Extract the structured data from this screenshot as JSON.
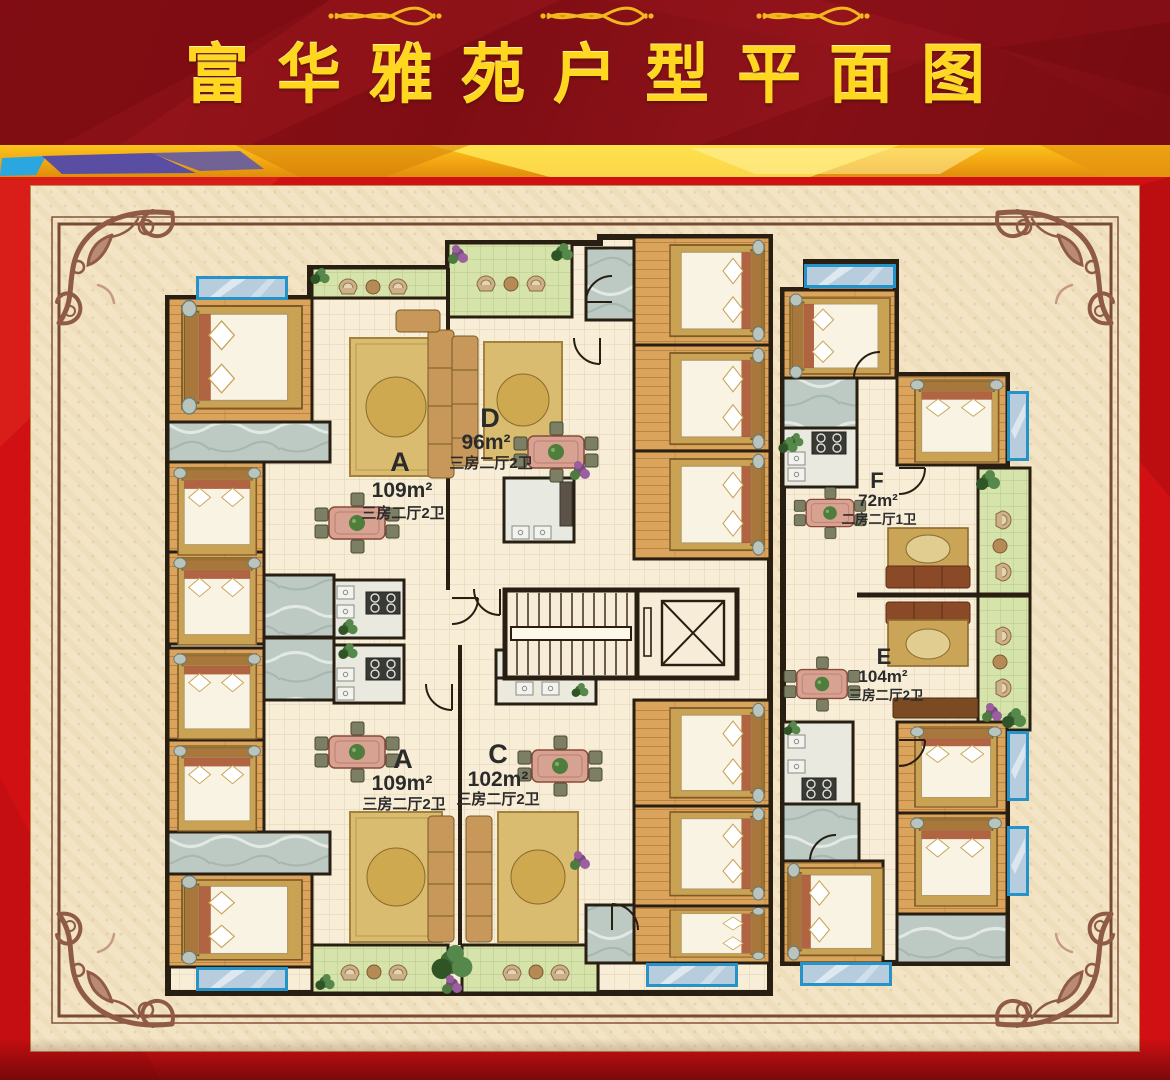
{
  "header": {
    "title": "富华雅苑户型平面图"
  },
  "plan": {
    "units": [
      {
        "letter": "A",
        "area": "109m²",
        "layout": "三房二厅2卫"
      },
      {
        "letter": "D",
        "area": "96m²",
        "layout": "三房二厅2卫"
      },
      {
        "letter": "A",
        "area": "109m²",
        "layout": "三房二厅2卫"
      },
      {
        "letter": "C",
        "area": "102m²",
        "layout": "三房二厅2卫"
      },
      {
        "letter": "F",
        "area": "72m²",
        "layout": "二房二厅1卫"
      },
      {
        "letter": "E",
        "area": "104m²",
        "layout": "三房二厅2卫"
      }
    ]
  },
  "colors": {
    "header_red": "#8e1118",
    "title_gold": "#ffd71e",
    "stripe_gold": "#f7b914",
    "stripe_blue": "#2ba7e0",
    "stripe_purple": "#5a4ea2",
    "board_red": "#d01013",
    "panel_cream": "#f2e4c4",
    "frame_brown": "#8a5a45",
    "wall_dark": "#281e12",
    "wood_floor": "#d9a45c",
    "tile_cream": "#f8edd6",
    "balcony_green": "#d6e3ab",
    "marble_gray": "#bdc9c3",
    "window_blue": "#2592c8"
  }
}
